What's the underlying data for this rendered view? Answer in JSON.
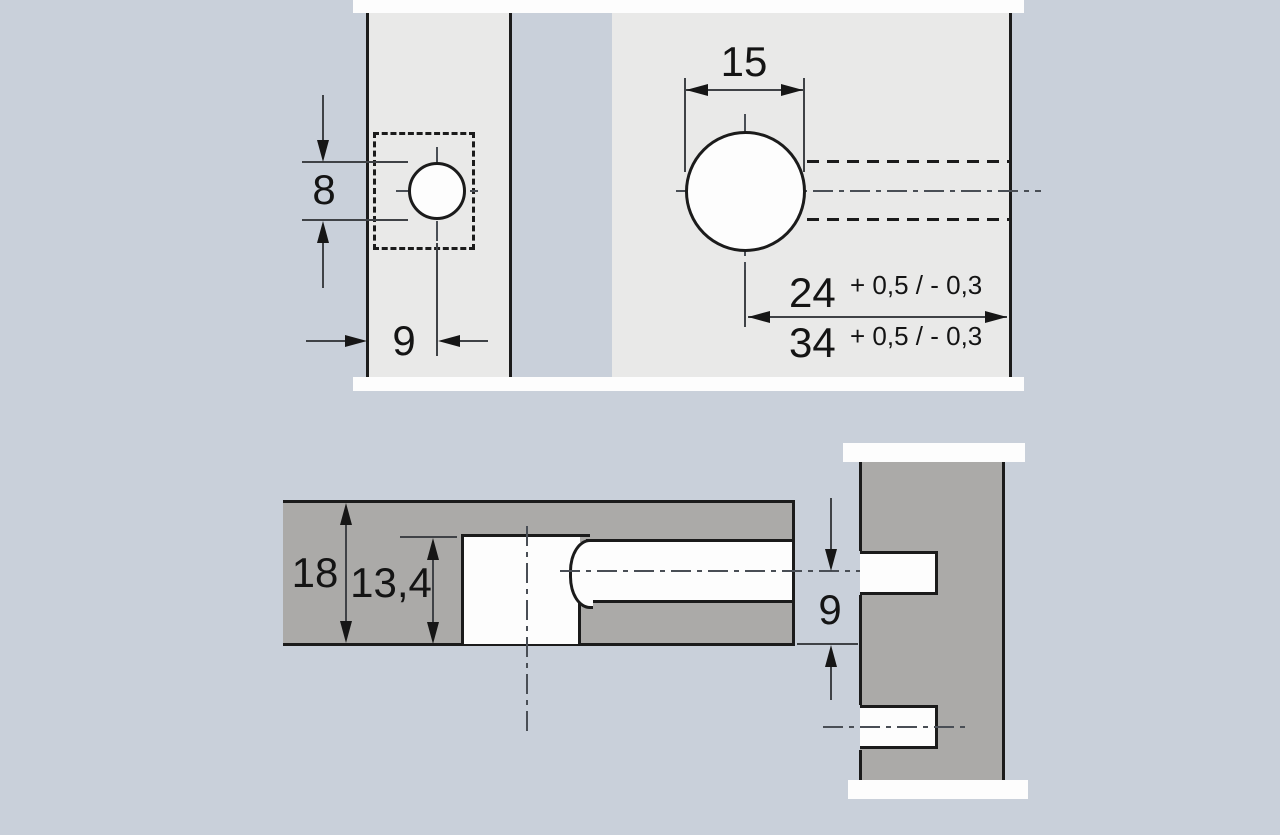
{
  "drawing": {
    "views": {
      "front": {
        "dims": {
          "pilot_hole_diameter": {
            "value": "8"
          },
          "pilot_hole_offset": {
            "value": "9"
          },
          "cup_hole_diameter": {
            "value": "15"
          },
          "bore_distance_a": {
            "value": "24",
            "tolerance": "+ 0,5 / - 0,3"
          },
          "bore_distance_b": {
            "value": "34",
            "tolerance": "+ 0,5 / - 0,3"
          }
        }
      },
      "section": {
        "dims": {
          "panel_thickness": {
            "value": "18"
          },
          "bore_depth": {
            "value": "13,4"
          },
          "edge_distance": {
            "value": "9"
          }
        }
      }
    },
    "colors": {
      "background": "#c9d0da",
      "panel_face": "#e9e9e8",
      "panel_section": "#abaaa8",
      "edge_line": "#1b1b1b",
      "dim_line": "#3f4246",
      "hole_fill": "#fdfdfd"
    }
  }
}
